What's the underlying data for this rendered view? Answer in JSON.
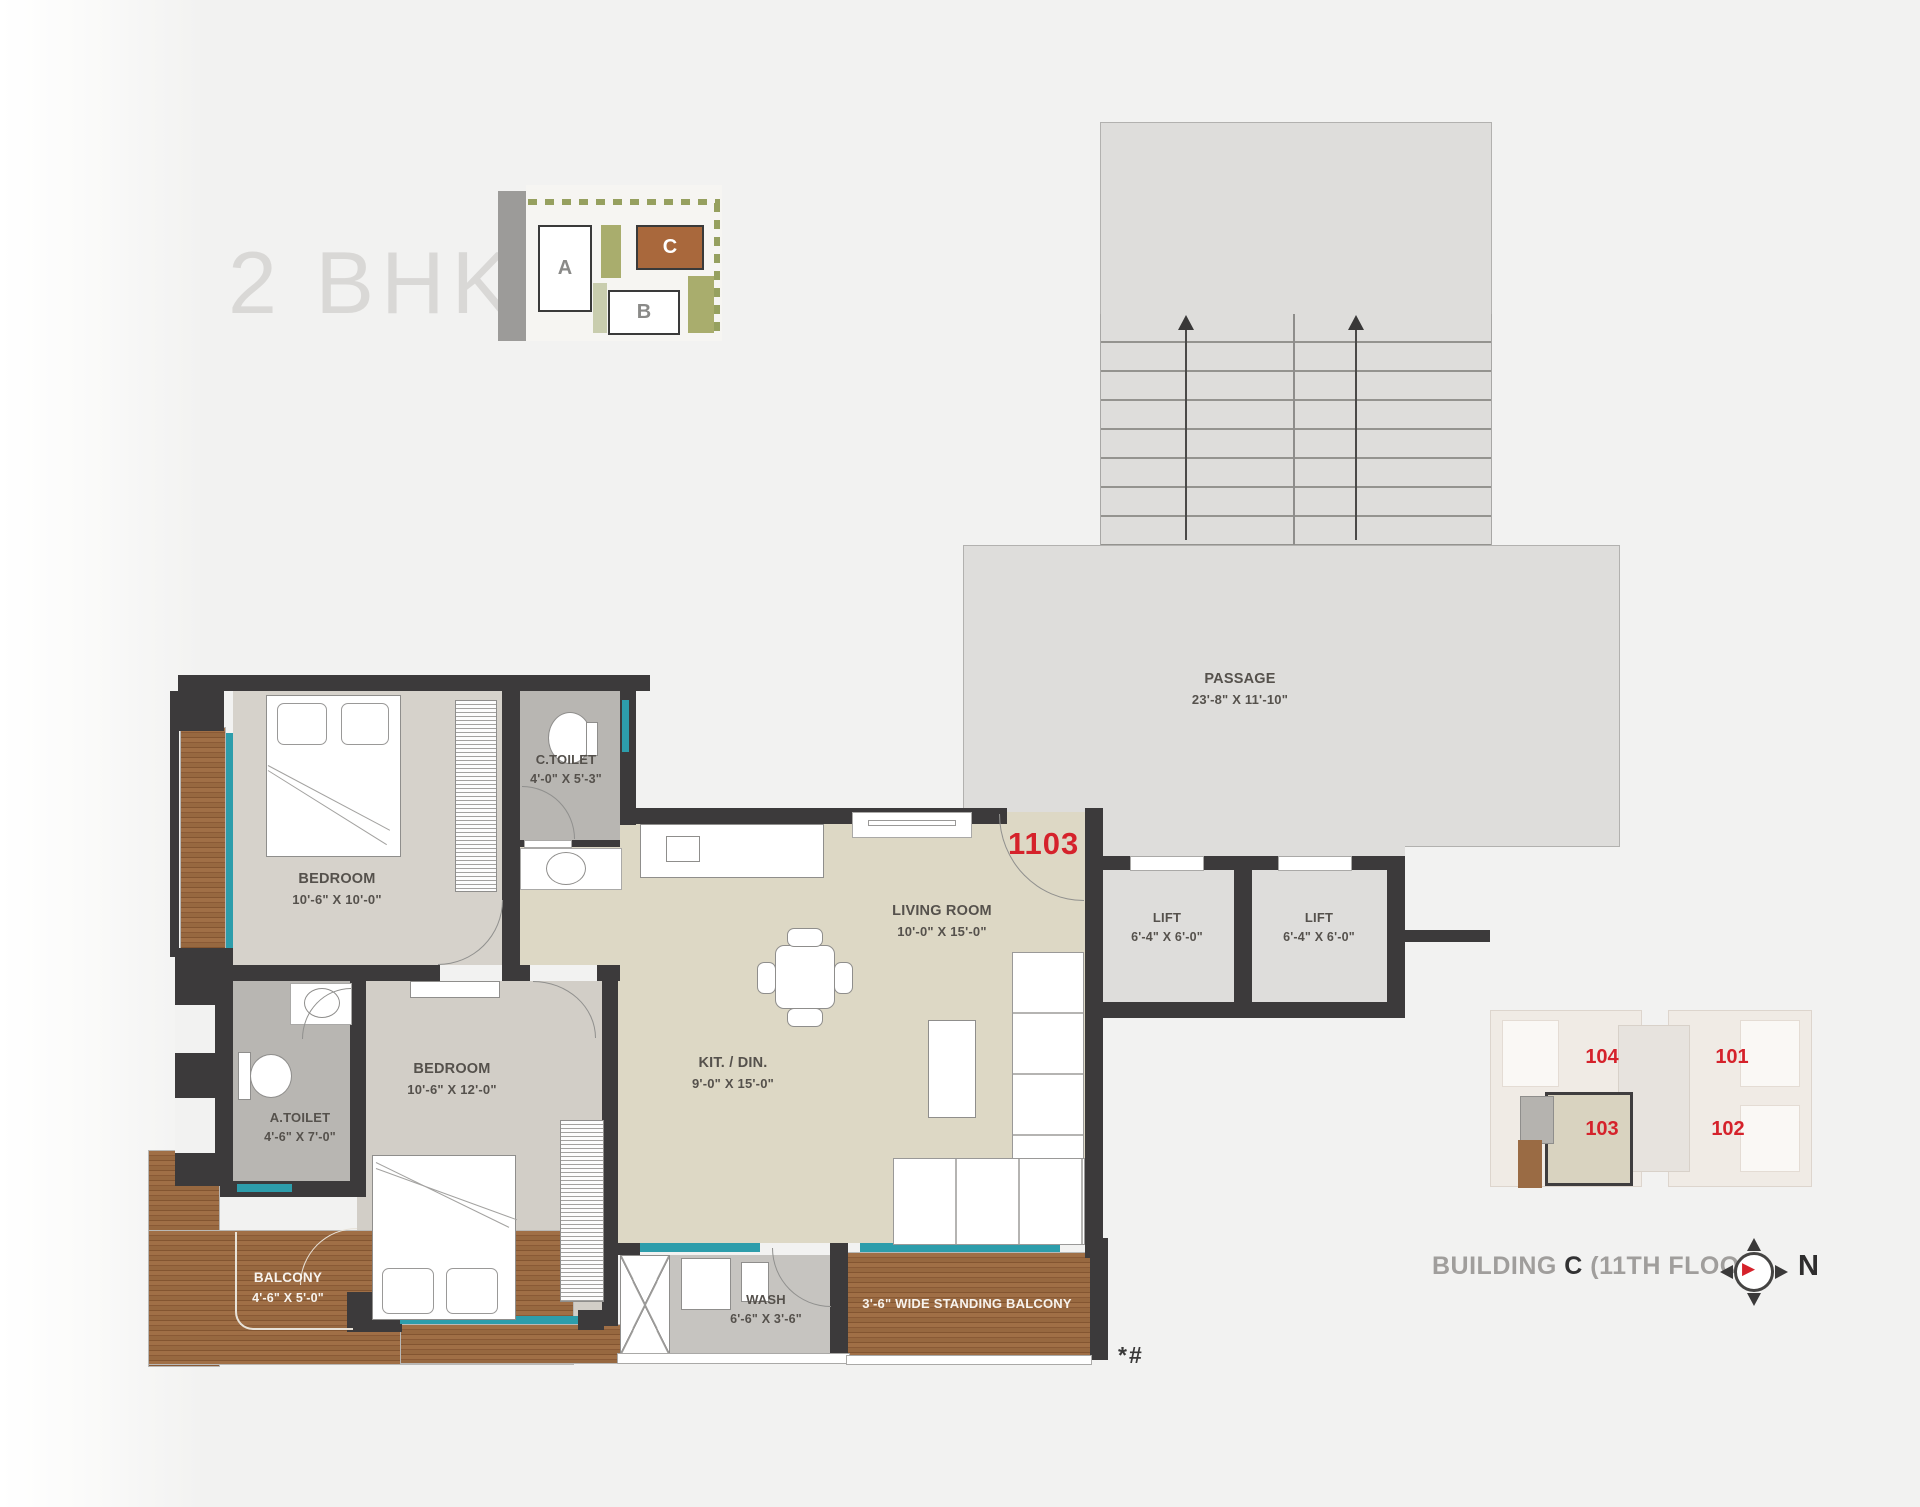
{
  "title": "2 BHK",
  "site_map": {
    "blocks": {
      "a": "A",
      "b": "B",
      "c": "C"
    },
    "highlighted_block": "C"
  },
  "unit": {
    "number": "1103"
  },
  "rooms": {
    "bedroom1": {
      "name": "BEDROOM",
      "dims": "10'-6\" X 10'-0\""
    },
    "ctoilet": {
      "name": "C.TOILET",
      "dims": "4'-0\" X 5'-3\""
    },
    "atoilet": {
      "name": "A.TOILET",
      "dims": "4'-6\" X 7'-0\""
    },
    "bedroom2": {
      "name": "BEDROOM",
      "dims": "10'-6\" X 12'-0\""
    },
    "balcony": {
      "name": "BALCONY",
      "dims": "4'-6\" X 5'-0\""
    },
    "kitdin": {
      "name": "KIT. / DIN.",
      "dims": "9'-0\" X 15'-0\""
    },
    "living": {
      "name": "LIVING ROOM",
      "dims": "10'-0\" X 15'-0\""
    },
    "wash": {
      "name": "WASH",
      "dims": "6'-6\" X 3'-6\""
    },
    "passage": {
      "name": "PASSAGE",
      "dims": "23'-8\" X 11'-10\""
    },
    "lift1": {
      "name": "LIFT",
      "dims": "6'-4\" X 6'-0\""
    },
    "lift2": {
      "name": "LIFT",
      "dims": "6'-4\" X 6'-0\""
    }
  },
  "standing_balcony_label": "3'-6\" WIDE STANDING BALCONY",
  "stairs": {
    "up": "UP",
    "dn": "DN"
  },
  "key_plan": {
    "units": {
      "u104": "104",
      "u101": "101",
      "u103": "103",
      "u102": "102"
    },
    "caption": {
      "building": "BUILDING ",
      "block": "C",
      "floor": " (11TH FLOOR)"
    },
    "north": "N"
  },
  "footnote": "*#",
  "colors": {
    "accent_red": "#d5222b",
    "wall": "#3c3a3b",
    "wood": "#9a6b44",
    "window_teal": "#2d9dab",
    "floor_beige": "#ddd8c5",
    "floor_gray": "#d6d2cb",
    "block_c_brown": "#a9683c"
  }
}
